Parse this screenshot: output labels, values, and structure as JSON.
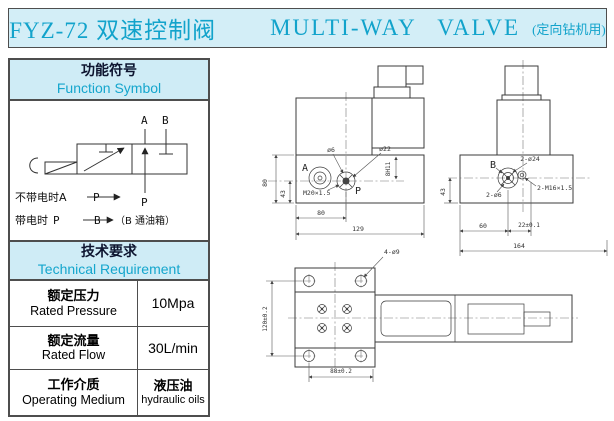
{
  "title": {
    "model": "FYZ-72",
    "cn": "双速控制阀",
    "en": "MULTI-WAY VALVE",
    "suffix": "(定向钻机用)"
  },
  "function_symbol": {
    "header_cn": "功能符号",
    "header_en": "Function Symbol",
    "port_a": "A",
    "port_b": "B",
    "port_p": "P",
    "line1_prefix": "不带电时A",
    "line1_port": "P",
    "line2_prefix": "带电时",
    "line2_p": "P",
    "line2_b": "B",
    "line2_suffix": "（B 通油箱）"
  },
  "technical": {
    "header_cn": "技术要求",
    "header_en": "Technical Requirement",
    "rows": [
      {
        "cn": "额定压力",
        "en": "Rated Pressure",
        "value": "10Mpa"
      },
      {
        "cn": "额定流量",
        "en": "Rated Flow",
        "value": "30L/min"
      },
      {
        "cn": "工作介质",
        "en": "Operating Medium",
        "value_cn": "液压油",
        "value_en": "hydraulic oils"
      }
    ]
  },
  "drawings": {
    "front": {
      "port_a": "A",
      "port_p": "P",
      "dia6": "ø6",
      "dia22": "ø22",
      "thread": "M20×1.5",
      "dim_h80": "80",
      "dim_h43": "43",
      "dim_8h11": "8H11",
      "dim_w80": "80",
      "dim_w129": "129"
    },
    "side": {
      "port_b": "B",
      "dia24": "2-ø24",
      "thread": "2-M16×1.5",
      "dia6": "2-ø6",
      "dim_43": "43",
      "dim_60": "60",
      "dim_22": "22±0.1",
      "dim_164": "164"
    },
    "top": {
      "holes": "4-ø9",
      "dim_h": "120±0.2",
      "dim_w": "88±0.2"
    }
  },
  "colors": {
    "accent": "#15a6cd",
    "panel_bg": "#cfecf6",
    "title_bg": "#d3eef7",
    "line": "#3b3b3b"
  }
}
